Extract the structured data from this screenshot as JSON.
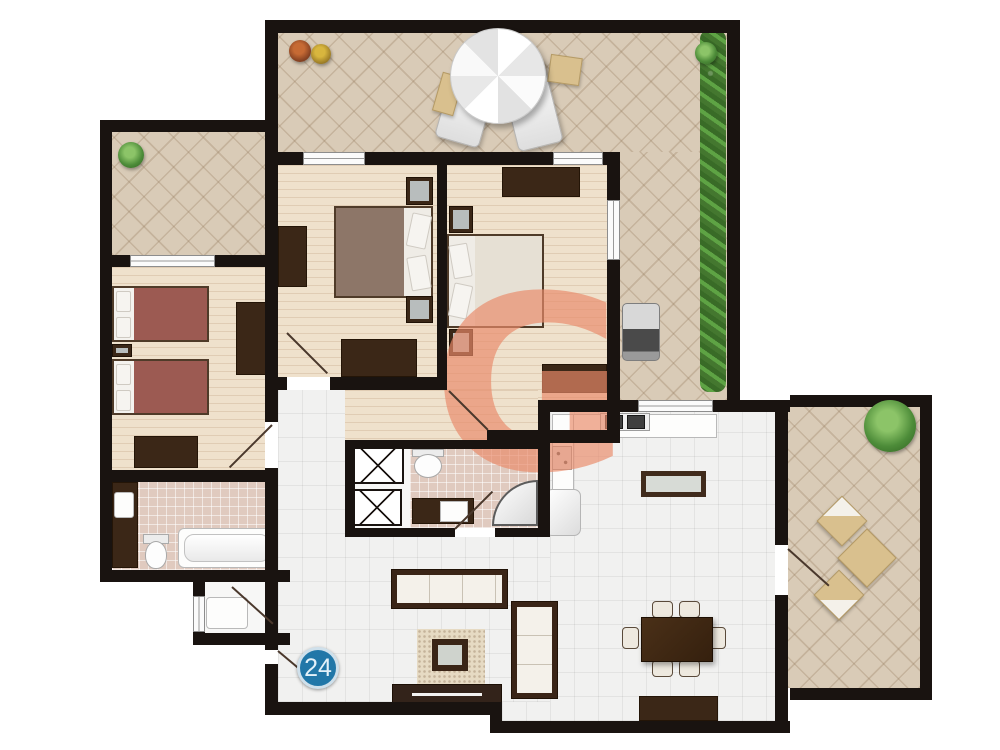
{
  "unit_badge": {
    "text": "24",
    "circle_color": "#2177a8",
    "ring_color": "#cfe0eb",
    "text_color": "#e3f1f9"
  },
  "watermark": {
    "letter": "G",
    "color": "#e88a69"
  },
  "palette": {
    "wall": "#191310",
    "terrace_tile": "#d9cbb7",
    "wood_floor": "#efe1cc",
    "white_tile": "#f1f1f0",
    "bath_tile": "#e0cabf",
    "dark_furniture": "#3b2717",
    "bed_cover_maroon": "#9c5a52",
    "bed_cover_brown": "#8d7668",
    "greenery": "#4d8c39"
  },
  "plan": {
    "type": "apartment-floor-plan",
    "unit_number": "24",
    "rooms": [
      {
        "name": "main-terrace",
        "floor": "beige-diamond-tile",
        "items": [
          "parasol",
          "two-loungers",
          "side-tables",
          "hedge",
          "potted-plants",
          "grill"
        ]
      },
      {
        "name": "left-terrace",
        "floor": "beige-diamond-tile",
        "items": [
          "potted-plant"
        ]
      },
      {
        "name": "twin-bedroom",
        "floor": "wood",
        "items": [
          "two-single-beds",
          "nightstand",
          "wardrobe",
          "dresser"
        ]
      },
      {
        "name": "middle-bedroom",
        "floor": "wood",
        "items": [
          "double-bed",
          "two-nightstands",
          "cabinet",
          "dresser"
        ]
      },
      {
        "name": "right-bedroom",
        "floor": "wood",
        "items": [
          "double-bed",
          "two-nightstands",
          "two-dressers"
        ]
      },
      {
        "name": "bathroom-1",
        "floor": "pink-tile",
        "items": [
          "vanity",
          "toilet",
          "bathtub"
        ]
      },
      {
        "name": "bathroom-2",
        "floor": "pink-tile",
        "items": [
          "toilet",
          "sink-counter",
          "corner-shower"
        ]
      },
      {
        "name": "shaft-closets",
        "floor": "white",
        "items": [
          "two-x-marked-shafts"
        ]
      },
      {
        "name": "kitchen",
        "floor": "white-tile",
        "items": [
          "l-shaped-counter",
          "two-burner-hob",
          "sink",
          "fridge",
          "island"
        ]
      },
      {
        "name": "living-dining",
        "floor": "white-tile",
        "items": [
          "sofa",
          "second-sofa",
          "coffee-table",
          "rug",
          "tv-stand",
          "dining-table-six-chairs",
          "sideboard"
        ]
      },
      {
        "name": "right-balcony",
        "floor": "beige-diamond-tile",
        "items": [
          "bistro-table",
          "two-chairs",
          "bush"
        ]
      },
      {
        "name": "entry-vestibule",
        "floor": "white",
        "items": [
          "cabinet"
        ]
      }
    ]
  }
}
